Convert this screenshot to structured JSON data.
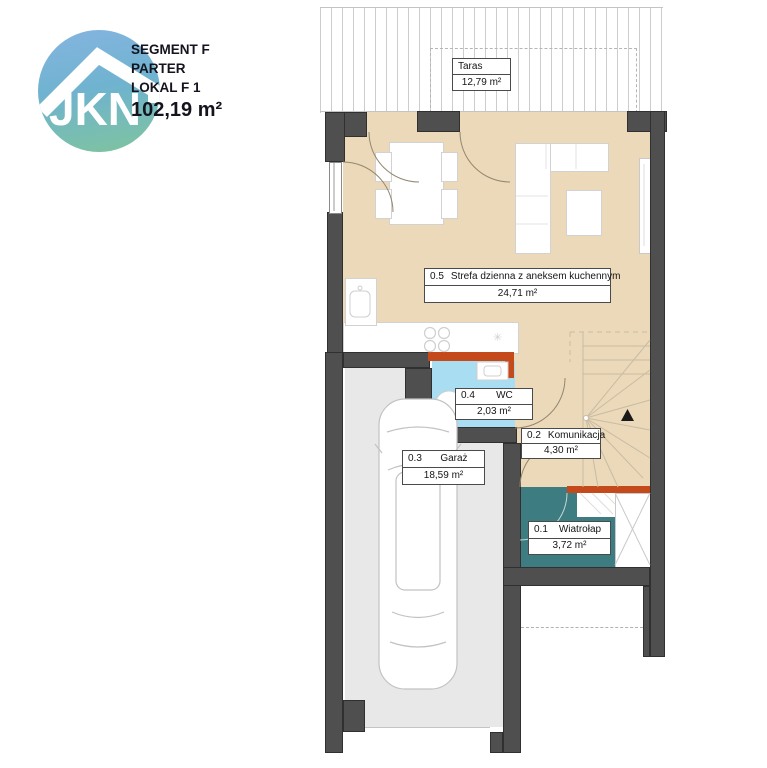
{
  "header": {
    "segment": "SEGMENT F",
    "floor": "PARTER",
    "unit": "LOKAL F 1",
    "total_area": "102,19 m²"
  },
  "logo": {
    "text": "JKN"
  },
  "rooms": [
    {
      "id": "",
      "name": "Taras",
      "area": "12,79 m²"
    },
    {
      "id": "0.5",
      "name": "Strefa dzienna z aneksem kuchennym",
      "area": "24,71 m²"
    },
    {
      "id": "0.4",
      "name": "WC",
      "area": "2,03 m²"
    },
    {
      "id": "0.2",
      "name": "Komunikacja",
      "area": "4,30 m²"
    },
    {
      "id": "0.3",
      "name": "Garaż",
      "area": "18,59 m²"
    },
    {
      "id": "0.1",
      "name": "Wiatrołap",
      "area": "3,72 m²"
    }
  ],
  "colors": {
    "floor_living": "#ecd9b9",
    "floor_garage": "#e8e8e8",
    "floor_wc": "#a9ddf1",
    "floor_entry": "#3d7c80",
    "wall": "#4f4f4f",
    "accent_wall": "#c54a1b",
    "logo_top": "#85b4e0",
    "logo_bottom": "#7fc49d"
  }
}
